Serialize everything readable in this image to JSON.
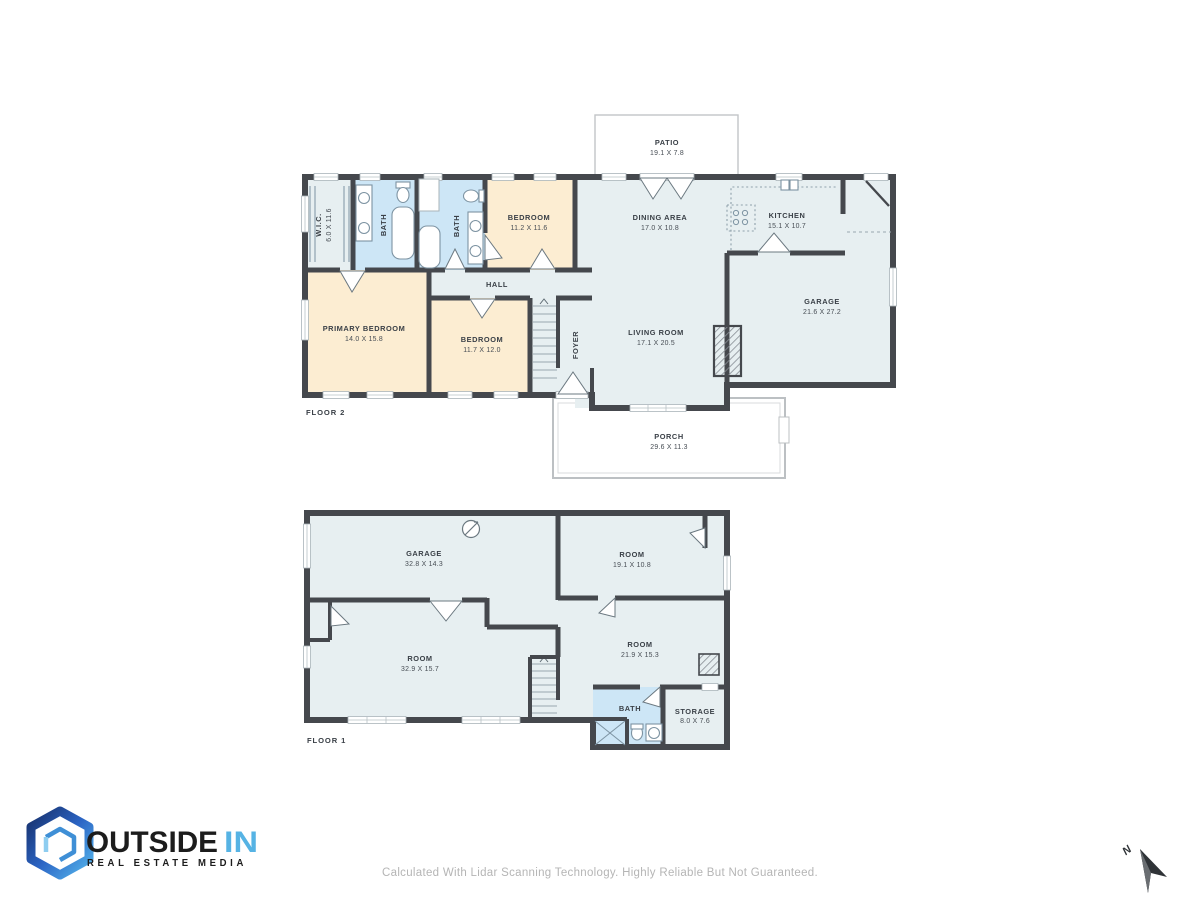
{
  "colors": {
    "wall": "#45484d",
    "room_light": "#e7eff1",
    "room_cream": "#fcedd2",
    "room_bath": "#cde6f6",
    "outdoor_outline": "#bcc0c3",
    "label_text": "#3a4047",
    "brand_dark": "#1c1c1c",
    "brand_accent": "#56b3e4",
    "footer_text": "#b5b5b5",
    "compass": "#2f3337"
  },
  "floor2": {
    "label": "FLOOR 2",
    "rooms": {
      "patio": {
        "name": "PATIO",
        "dims": "19.1 X 7.8"
      },
      "wic": {
        "name": "W.I.C.",
        "dims": "6.0 X 11.6"
      },
      "bath_a": {
        "name": "BATH"
      },
      "bath_b": {
        "name": "BATH"
      },
      "bedroom_a": {
        "name": "BEDROOM",
        "dims": "11.2 X 11.6"
      },
      "dining": {
        "name": "DINING AREA",
        "dims": "17.0 X 10.8"
      },
      "kitchen": {
        "name": "KITCHEN",
        "dims": "15.1 X 10.7"
      },
      "garage": {
        "name": "GARAGE",
        "dims": "21.6 X 27.2"
      },
      "primary": {
        "name": "PRIMARY BEDROOM",
        "dims": "14.0 X 15.8"
      },
      "bedroom_b": {
        "name": "BEDROOM",
        "dims": "11.7 X 12.0"
      },
      "hall": {
        "name": "HALL"
      },
      "foyer": {
        "name": "FOYER"
      },
      "living": {
        "name": "LIVING ROOM",
        "dims": "17.1 X 20.5"
      },
      "porch": {
        "name": "PORCH",
        "dims": "29.6 X 11.3"
      }
    }
  },
  "floor1": {
    "label": "FLOOR 1",
    "rooms": {
      "garage": {
        "name": "GARAGE",
        "dims": "32.8 X 14.3"
      },
      "room_upper": {
        "name": "ROOM",
        "dims": "19.1 X 10.8"
      },
      "room_large": {
        "name": "ROOM",
        "dims": "32.9 X 15.7"
      },
      "room_lower": {
        "name": "ROOM",
        "dims": "21.9 X 15.3"
      },
      "bath": {
        "name": "BATH"
      },
      "storage": {
        "name": "STORAGE",
        "dims": "8.0 X 7.6"
      }
    }
  },
  "brand": {
    "word_primary": "OUTSIDE",
    "word_accent": "IN",
    "tagline": "REAL ESTATE MEDIA"
  },
  "compass": {
    "label": "N"
  },
  "footer": {
    "disclaimer": "Calculated With Lidar Scanning Technology. Highly Reliable But Not Guaranteed."
  }
}
